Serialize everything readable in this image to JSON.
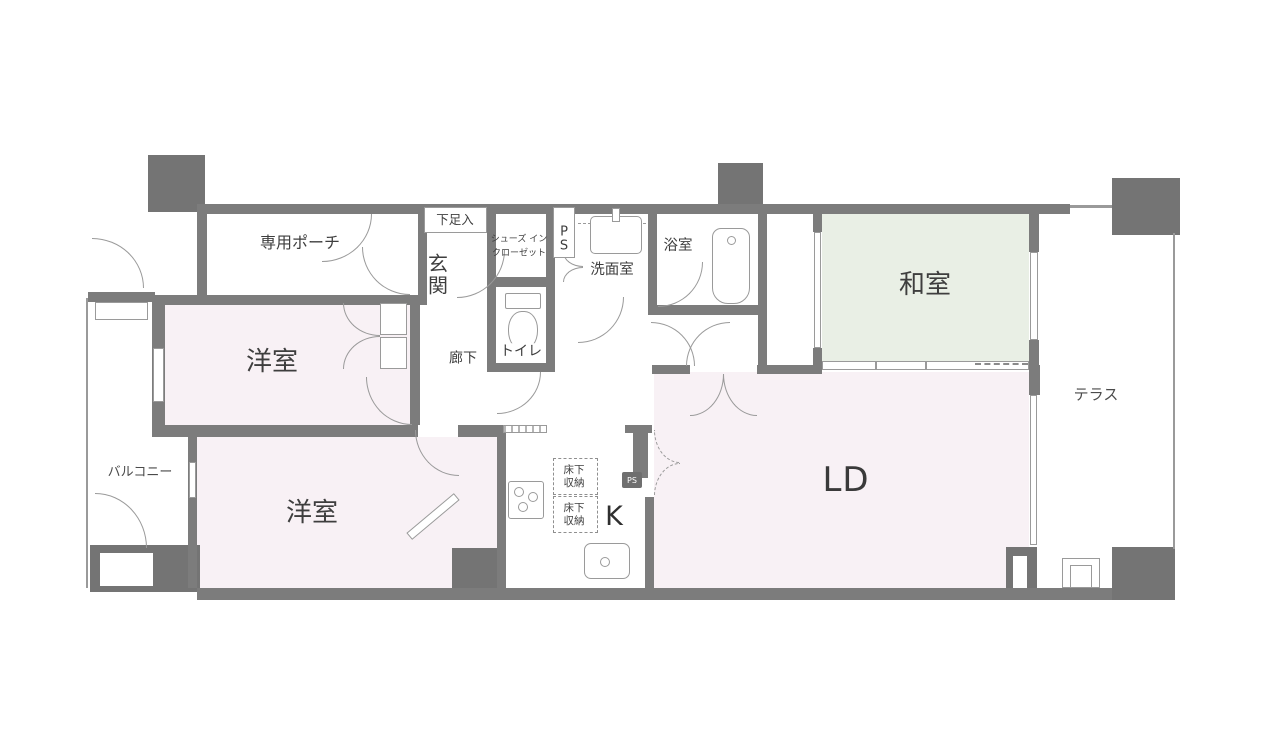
{
  "plan_type": "apartment-floor-plan",
  "rooms": {
    "private_porch": {
      "label": "専用ポーチ"
    },
    "shoe_cabinet": {
      "label": "下足入"
    },
    "entrance": {
      "label": "玄関"
    },
    "shoes_in_closet": {
      "label": "シューズ イン\nクローゼット"
    },
    "pipe_space_entry": {
      "label": "PS"
    },
    "washroom": {
      "label": "洗面室"
    },
    "bathroom": {
      "label": "浴室"
    },
    "japanese_room": {
      "label": "和室"
    },
    "terrace": {
      "label": "テラス"
    },
    "western_room_upper": {
      "label": "洋室"
    },
    "corridor": {
      "label": "廊下"
    },
    "toilet": {
      "label": "トイレ"
    },
    "balcony": {
      "label": "バルコニー"
    },
    "western_room_lower": {
      "label": "洋室"
    },
    "kitchen": {
      "label": "K"
    },
    "living_dining": {
      "label": "LD"
    },
    "underfloor_storage_1": {
      "label": "床下収納"
    },
    "underfloor_storage_2": {
      "label": "床下収納"
    },
    "pipe_space_kitchen": {
      "label": "PS"
    }
  },
  "colors": {
    "wall": "#7c7c7c",
    "corner_block": "#747474",
    "western_room_fill": "#f8f1f5",
    "living_dining_fill": "#f8f1f5",
    "japanese_room_fill": "#e9efe5",
    "line": "#9a9a9a",
    "text": "#3e3e3e"
  }
}
